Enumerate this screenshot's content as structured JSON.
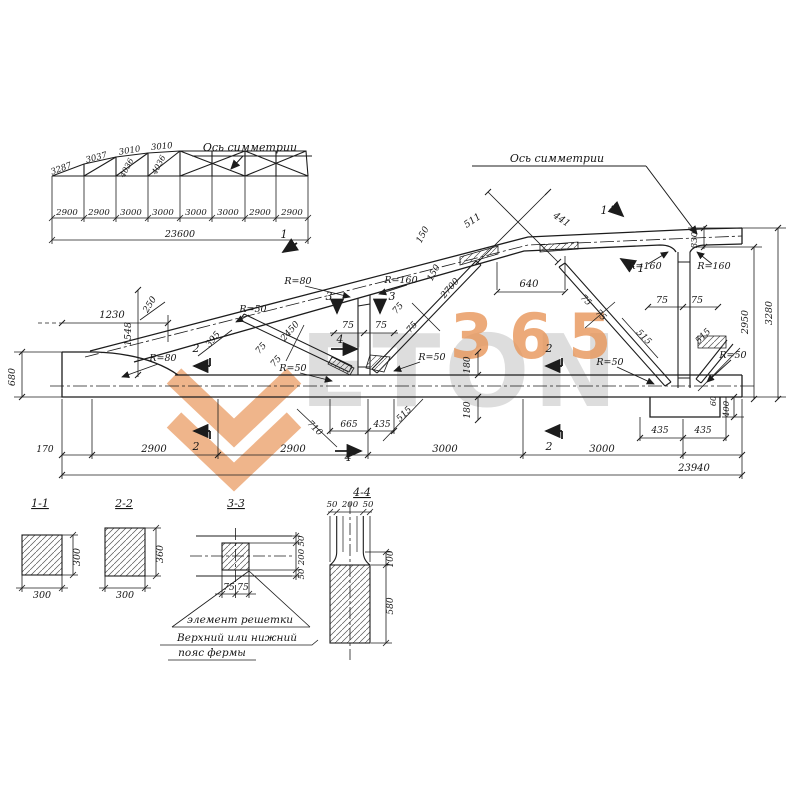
{
  "drawing": {
    "watermark": {
      "word": "ETON",
      "number": "365",
      "orange": "#e8965a",
      "gray": "#bcbcbc"
    },
    "schematic": {
      "labels": [
        {
          "t": "Ось симметрии",
          "x": 250,
          "y": 151,
          "s": 11,
          "n": "symmetry-axis-label"
        },
        {
          "t": "3287",
          "x": 62,
          "y": 171,
          "r": -20,
          "s": 8.5
        },
        {
          "t": "3037",
          "x": 97,
          "y": 160,
          "r": -15,
          "s": 8.5
        },
        {
          "t": "3010",
          "x": 130,
          "y": 153,
          "r": -9,
          "s": 8.5
        },
        {
          "t": "3010",
          "x": 162,
          "y": 149,
          "r": -5,
          "s": 8.5
        },
        {
          "t": "4036",
          "x": 129,
          "y": 169,
          "r": -62,
          "s": 8
        },
        {
          "t": "4036",
          "x": 161,
          "y": 166,
          "r": -62,
          "s": 8
        },
        {
          "t": "2900",
          "x": 67,
          "y": 215,
          "s": 8.5
        },
        {
          "t": "2900",
          "x": 99,
          "y": 215,
          "s": 8.5
        },
        {
          "t": "3000",
          "x": 131,
          "y": 215,
          "s": 8.5
        },
        {
          "t": "3000",
          "x": 163,
          "y": 215,
          "s": 8.5
        },
        {
          "t": "3000",
          "x": 196,
          "y": 215,
          "s": 8.5
        },
        {
          "t": "3000",
          "x": 228,
          "y": 215,
          "s": 8.5
        },
        {
          "t": "2900",
          "x": 260,
          "y": 215,
          "s": 8.5
        },
        {
          "t": "2900",
          "x": 292,
          "y": 215,
          "s": 8.5
        },
        {
          "t": "23600",
          "x": 180,
          "y": 237,
          "s": 9.5
        }
      ]
    },
    "main_view": {
      "labels": [
        {
          "t": "Ось симметрии",
          "x": 557,
          "y": 162,
          "s": 11,
          "n": "symmetry-axis-label"
        },
        {
          "t": "680",
          "x": 15,
          "y": 377,
          "r": -90,
          "s": 9.5
        },
        {
          "t": "1230",
          "x": 112,
          "y": 318,
          "s": 10
        },
        {
          "t": "1548",
          "x": 131,
          "y": 334,
          "r": -90,
          "s": 9.5
        },
        {
          "t": "250",
          "x": 152,
          "y": 306,
          "r": -58,
          "s": 9
        },
        {
          "t": "395",
          "x": 215,
          "y": 341,
          "r": -50,
          "s": 9
        },
        {
          "t": "R=80",
          "x": 163,
          "y": 361,
          "s": 9.5
        },
        {
          "t": "R=50",
          "x": 253,
          "y": 312,
          "s": 9.5
        },
        {
          "t": "2450",
          "x": 292,
          "y": 333,
          "r": -49,
          "s": 9
        },
        {
          "t": "75",
          "x": 263,
          "y": 350,
          "r": -49,
          "s": 9
        },
        {
          "t": "75",
          "x": 278,
          "y": 363,
          "r": -49,
          "s": 9
        },
        {
          "t": "R=50",
          "x": 293,
          "y": 371,
          "s": 9.5
        },
        {
          "t": "R=80",
          "x": 298,
          "y": 284,
          "s": 9.5
        },
        {
          "t": "R=160",
          "x": 401,
          "y": 283,
          "s": 9.5
        },
        {
          "t": "3",
          "x": 329,
          "y": 300,
          "s": 11
        },
        {
          "t": "3",
          "x": 392,
          "y": 300,
          "s": 11
        },
        {
          "t": "75",
          "x": 348,
          "y": 328,
          "s": 9.5
        },
        {
          "t": "75",
          "x": 381,
          "y": 328,
          "s": 9.5
        },
        {
          "t": "4",
          "x": 340,
          "y": 343,
          "s": 11
        },
        {
          "t": "2700",
          "x": 452,
          "y": 290,
          "r": -49,
          "s": 9
        },
        {
          "t": "75",
          "x": 400,
          "y": 310,
          "r": -49,
          "s": 9
        },
        {
          "t": "75",
          "x": 414,
          "y": 329,
          "r": -49,
          "s": 9
        },
        {
          "t": "R=50",
          "x": 432,
          "y": 360,
          "s": 9.5
        },
        {
          "t": "150",
          "x": 425,
          "y": 236,
          "r": -62,
          "s": 9
        },
        {
          "t": "150",
          "x": 436,
          "y": 274,
          "r": -62,
          "s": 9
        },
        {
          "t": "511",
          "x": 474,
          "y": 223,
          "r": -34,
          "s": 9.5
        },
        {
          "t": "441",
          "x": 560,
          "y": 222,
          "r": 34,
          "s": 9.5
        },
        {
          "t": "640",
          "x": 529,
          "y": 287,
          "s": 10
        },
        {
          "t": "1",
          "x": 284,
          "y": 238,
          "s": 11
        },
        {
          "t": "1",
          "x": 604,
          "y": 214,
          "s": 11
        },
        {
          "t": "1",
          "x": 641,
          "y": 272,
          "s": 11
        },
        {
          "t": "2",
          "x": 196,
          "y": 352,
          "s": 11
        },
        {
          "t": "2",
          "x": 196,
          "y": 450,
          "s": 11
        },
        {
          "t": "2",
          "x": 549,
          "y": 352,
          "s": 11
        },
        {
          "t": "2",
          "x": 549,
          "y": 450,
          "s": 11
        },
        {
          "t": "710",
          "x": 313,
          "y": 430,
          "r": 44,
          "s": 9
        },
        {
          "t": "665",
          "x": 349,
          "y": 427,
          "s": 9
        },
        {
          "t": "435",
          "x": 382,
          "y": 427,
          "s": 9
        },
        {
          "t": "515",
          "x": 406,
          "y": 416,
          "r": -45,
          "s": 9
        },
        {
          "t": "4",
          "x": 348,
          "y": 461,
          "s": 11
        },
        {
          "t": "180",
          "x": 470,
          "y": 365,
          "r": -90,
          "s": 9
        },
        {
          "t": "180",
          "x": 470,
          "y": 410,
          "r": -90,
          "s": 9
        },
        {
          "t": "75",
          "x": 584,
          "y": 302,
          "r": 45,
          "s": 9
        },
        {
          "t": "75",
          "x": 599,
          "y": 317,
          "r": 45,
          "s": 9
        },
        {
          "t": "515",
          "x": 642,
          "y": 339,
          "r": 45,
          "s": 9
        },
        {
          "t": "515",
          "x": 705,
          "y": 338,
          "r": -45,
          "s": 9
        },
        {
          "t": "R=50",
          "x": 610,
          "y": 365,
          "s": 9.5
        },
        {
          "t": "R=50",
          "x": 733,
          "y": 358,
          "s": 9.5
        },
        {
          "t": "R=160",
          "x": 645,
          "y": 269,
          "s": 9.5
        },
        {
          "t": "R=160",
          "x": 714,
          "y": 269,
          "s": 9.5
        },
        {
          "t": "75",
          "x": 662,
          "y": 303,
          "s": 9.5
        },
        {
          "t": "75",
          "x": 697,
          "y": 303,
          "s": 9.5
        },
        {
          "t": "330",
          "x": 697,
          "y": 240,
          "r": -90,
          "s": 8.5
        },
        {
          "t": "2950",
          "x": 748,
          "y": 322,
          "r": -90,
          "s": 9.5
        },
        {
          "t": "3280",
          "x": 772,
          "y": 313,
          "r": -90,
          "s": 9.5
        },
        {
          "t": "435",
          "x": 660,
          "y": 433,
          "s": 9
        },
        {
          "t": "435",
          "x": 703,
          "y": 433,
          "s": 9
        },
        {
          "t": "400",
          "x": 729,
          "y": 409,
          "r": -90,
          "s": 8.5
        },
        {
          "t": "60",
          "x": 716,
          "y": 401,
          "r": -90,
          "s": 8
        },
        {
          "t": "170",
          "x": 45,
          "y": 452,
          "s": 9
        },
        {
          "t": "2900",
          "x": 154,
          "y": 452,
          "s": 10
        },
        {
          "t": "2900",
          "x": 293,
          "y": 452,
          "s": 10
        },
        {
          "t": "3000",
          "x": 445,
          "y": 452,
          "s": 10
        },
        {
          "t": "3000",
          "x": 602,
          "y": 452,
          "s": 10
        },
        {
          "t": "23940",
          "x": 694,
          "y": 471,
          "s": 10
        }
      ]
    },
    "sections": {
      "labels": [
        {
          "t": "1-1",
          "x": 40,
          "y": 507,
          "s": 11,
          "u": 1,
          "n": "section-title-1-1"
        },
        {
          "t": "300",
          "x": 42,
          "y": 598,
          "s": 9.5
        },
        {
          "t": "300",
          "x": 80,
          "y": 557,
          "r": -90,
          "s": 9.5
        },
        {
          "t": "2-2",
          "x": 124,
          "y": 507,
          "s": 11,
          "u": 1,
          "n": "section-title-2-2"
        },
        {
          "t": "300",
          "x": 125,
          "y": 598,
          "s": 9.5
        },
        {
          "t": "360",
          "x": 163,
          "y": 554,
          "r": -90,
          "s": 9.5
        },
        {
          "t": "3-3",
          "x": 236,
          "y": 507,
          "s": 11,
          "u": 1,
          "n": "section-title-3-3"
        },
        {
          "t": "50",
          "x": 304,
          "y": 541,
          "r": -90,
          "s": 8.5
        },
        {
          "t": "200",
          "x": 304,
          "y": 557,
          "r": -90,
          "s": 8.5
        },
        {
          "t": "50",
          "x": 304,
          "y": 574,
          "r": -90,
          "s": 8.5
        },
        {
          "t": "75",
          "x": 229,
          "y": 590,
          "s": 9
        },
        {
          "t": "75",
          "x": 243,
          "y": 590,
          "s": 9
        },
        {
          "t": "элемент решетки",
          "x": 240,
          "y": 623,
          "s": 10.5,
          "n": "callout-lattice-element"
        },
        {
          "t": "Верхний или нижний",
          "x": 237,
          "y": 641,
          "s": 10.5,
          "n": "callout-chord-line1"
        },
        {
          "t": "пояс фермы",
          "x": 212,
          "y": 656,
          "s": 10.5,
          "n": "callout-chord-line2"
        },
        {
          "t": "4-4",
          "x": 362,
          "y": 496,
          "s": 11,
          "u": 1,
          "n": "section-title-4-4"
        },
        {
          "t": "50",
          "x": 332,
          "y": 507,
          "s": 8.5
        },
        {
          "t": "200",
          "x": 350,
          "y": 507,
          "s": 8.5
        },
        {
          "t": "50",
          "x": 368,
          "y": 507,
          "s": 8.5
        },
        {
          "t": "100",
          "x": 393,
          "y": 559,
          "r": -90,
          "s": 9
        },
        {
          "t": "580",
          "x": 393,
          "y": 606,
          "r": -90,
          "s": 9
        }
      ]
    }
  }
}
